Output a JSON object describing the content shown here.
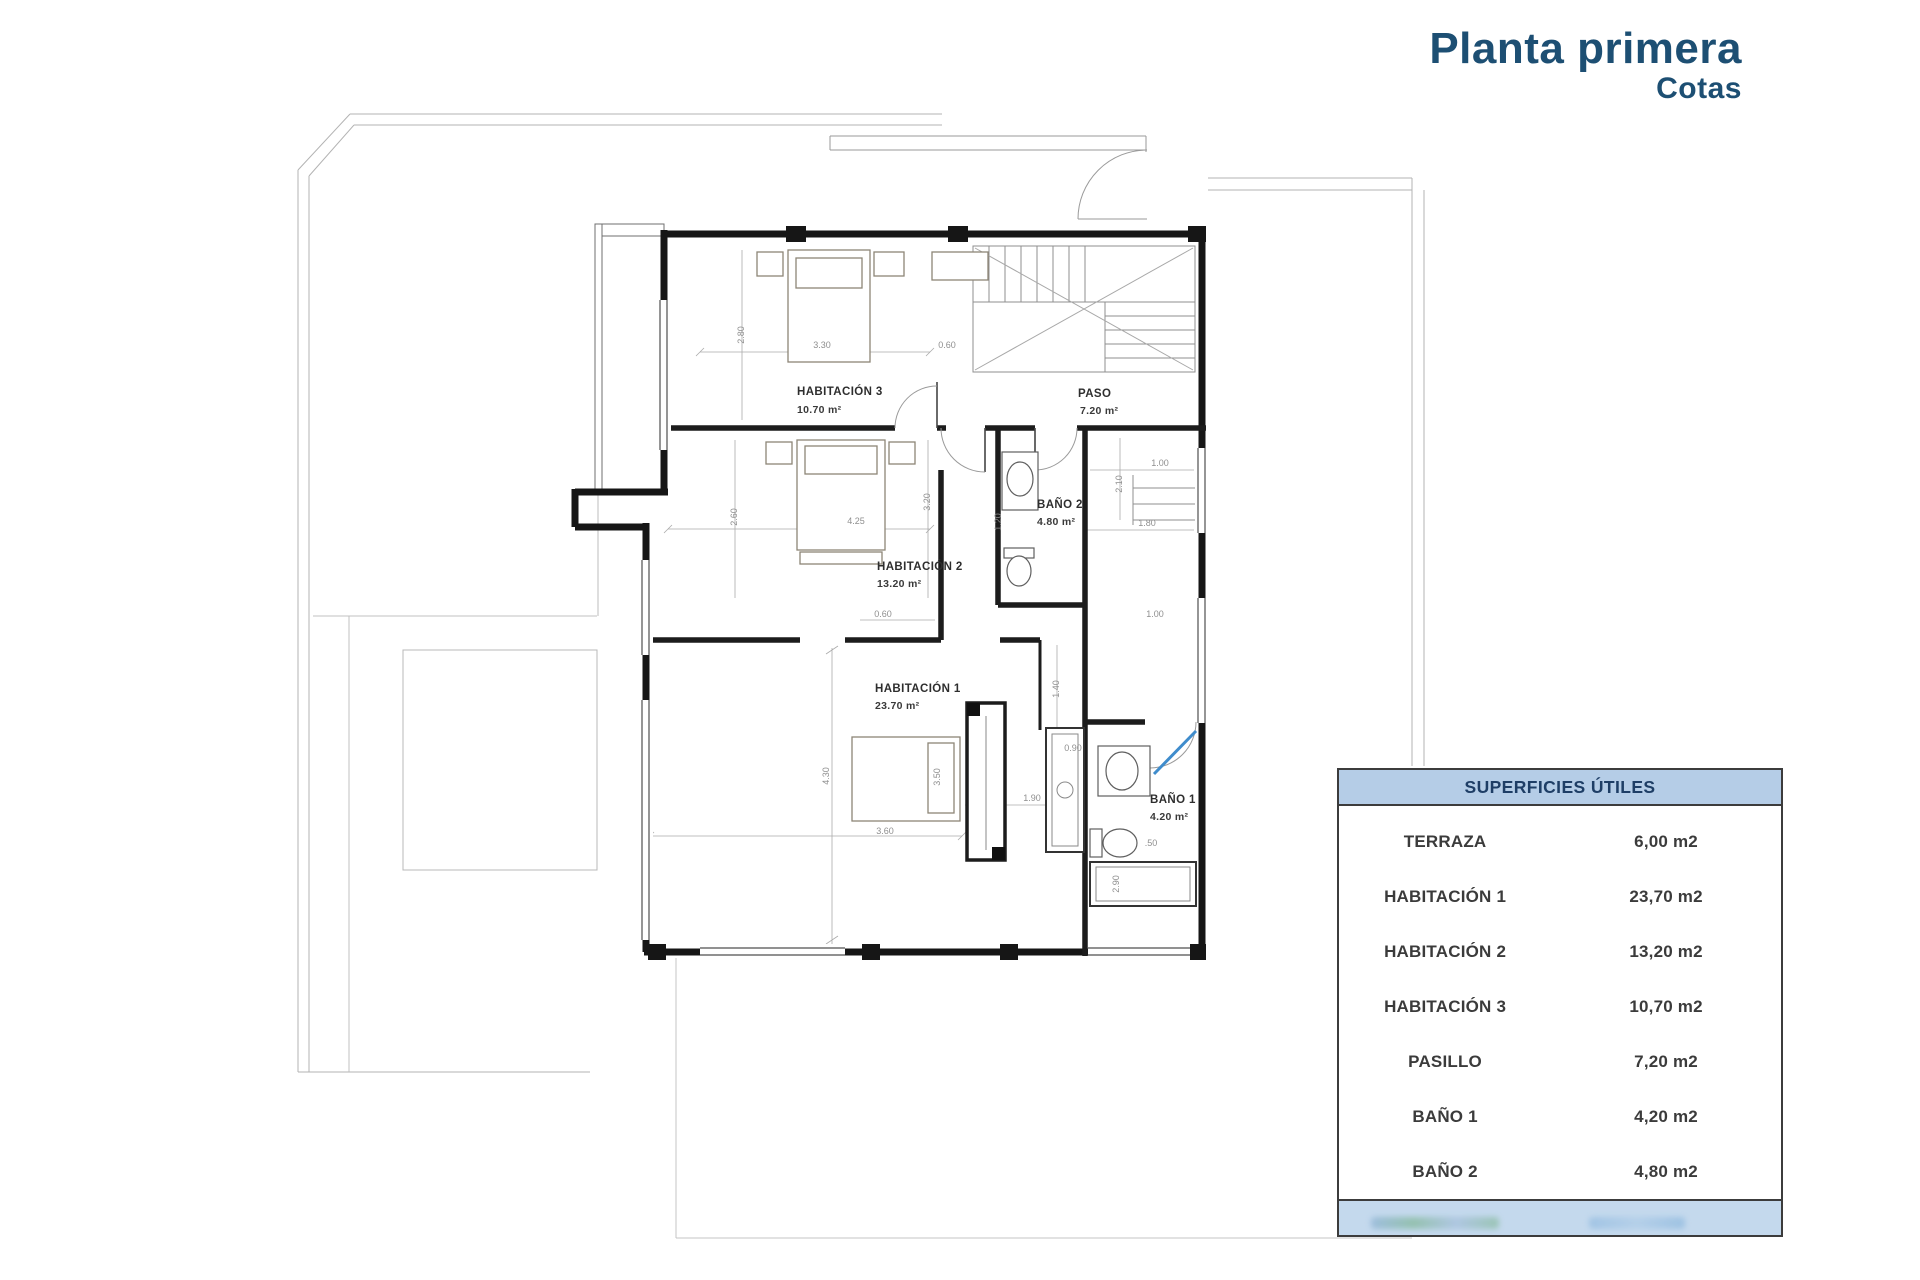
{
  "title": {
    "main": "Planta primera",
    "subtitle": "Cotas"
  },
  "plan": {
    "rooms": [
      {
        "name": "HABITACIÓN 3",
        "area": "10.70 m²"
      },
      {
        "name": "PASO",
        "area": "7.20 m²"
      },
      {
        "name": "BAÑO 2",
        "area": "4.80 m²"
      },
      {
        "name": "HABITACIÓN 2",
        "area": "13.20 m²"
      },
      {
        "name": "HABITACIÓN 1",
        "area": "23.70 m²"
      },
      {
        "name": "BAÑO 1",
        "area": "4.20 m²"
      }
    ],
    "dims": [
      "2.80",
      "3.30",
      "0.60",
      "2.60",
      "4.25",
      "3.20",
      "1.20",
      "2.10",
      "1.00",
      "1.80",
      "0.60",
      "1.00",
      "1.40",
      "0.90",
      "1.90",
      "3.50",
      "3.60",
      "4.30",
      ".50",
      "2.90"
    ]
  },
  "table": {
    "header": "SUPERFICIES ÚTILES",
    "rows": [
      {
        "label": "TERRAZA",
        "value": "6,00 m2"
      },
      {
        "label": "HABITACIÓN 1",
        "value": "23,70 m2"
      },
      {
        "label": "HABITACIÓN 2",
        "value": "13,20 m2"
      },
      {
        "label": "HABITACIÓN 3",
        "value": "10,70 m2"
      },
      {
        "label": "PASILLO",
        "value": "7,20 m2"
      },
      {
        "label": "BAÑO 1",
        "value": "4,20 m2"
      },
      {
        "label": "BAÑO 2",
        "value": "4,80 m2"
      }
    ]
  },
  "colors": {
    "title": "#1d4f73",
    "table_header_bg": "#b5cde7",
    "table_footer_bg": "#c4d9ed",
    "wall": "#161616",
    "accent_blue": "#3f8ccc"
  }
}
